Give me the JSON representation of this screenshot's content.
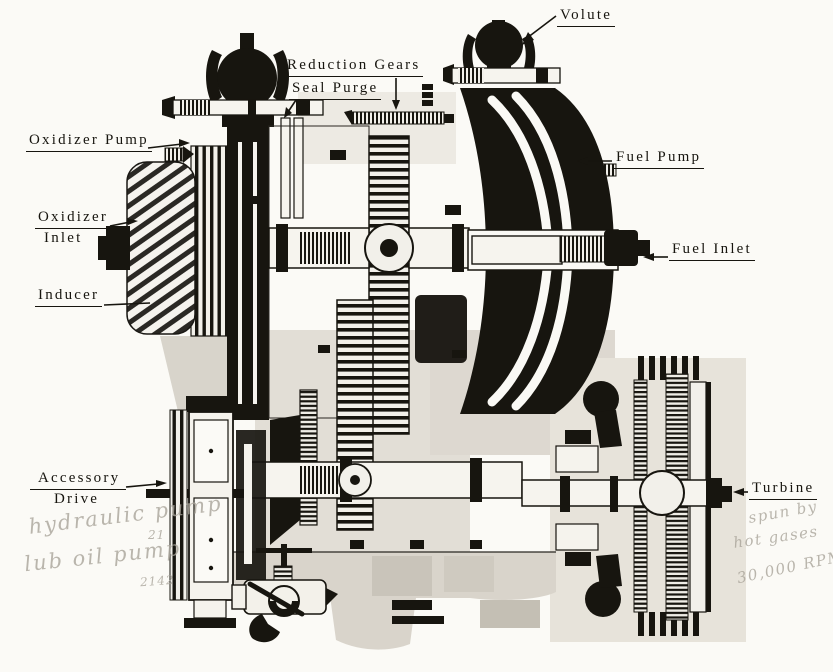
{
  "figure": {
    "type": "engineering-cutaway-diagram",
    "subject": "Turbopump cross-section with callout labels",
    "colors": {
      "paper": "#fbfaf6",
      "ink": "#17150f",
      "halftone_gray": "#dcd7ce",
      "pencil": "#a9a49a"
    }
  },
  "labels": {
    "volute": "Volute",
    "reduction_gears": "Reduction Gears",
    "seal_purge": "Seal Purge",
    "oxidizer_pump": "Oxidizer Pump",
    "oxidizer_inlet": {
      "line1": "Oxidizer",
      "line2": "Inlet"
    },
    "inducer": "Inducer",
    "fuel_pump": "Fuel Pump",
    "fuel_inlet": "Fuel Inlet",
    "accessory_drive": {
      "line1": "Accessory",
      "line2": "Drive"
    },
    "turbine": "Turbine"
  },
  "handwritten_notes": {
    "left": {
      "line1": "hydraulic pump",
      "line1_sub": "21",
      "line2": "lub oil pump",
      "line2_sub": "2142"
    },
    "right": {
      "line1": "spun by",
      "line2": "hot gases",
      "line3": "30,000 RPM"
    }
  }
}
